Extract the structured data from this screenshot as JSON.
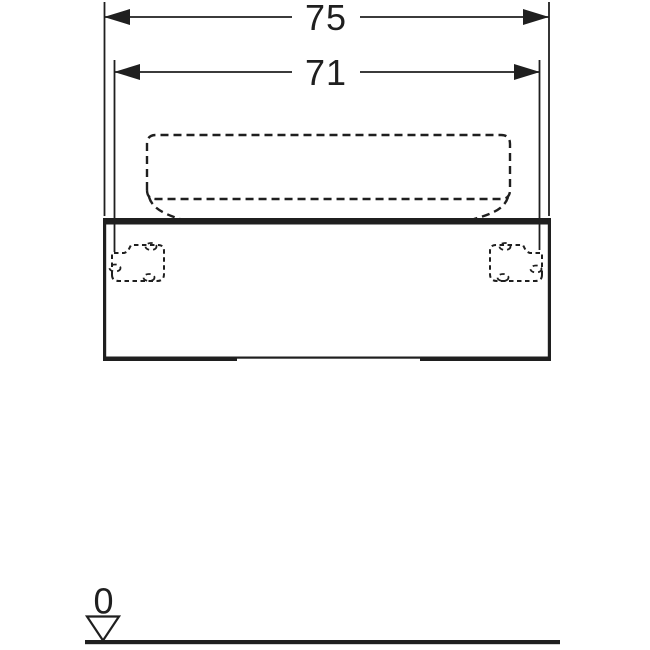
{
  "drawing": {
    "kind": "washbasin-cabinet-front-elevation",
    "colors": {
      "background": "#ffffff",
      "line": "#1f1f1f"
    },
    "dimensions": {
      "total_width_label": "75",
      "fixing_width_label": "71"
    },
    "datum": {
      "level_label": "0"
    }
  }
}
